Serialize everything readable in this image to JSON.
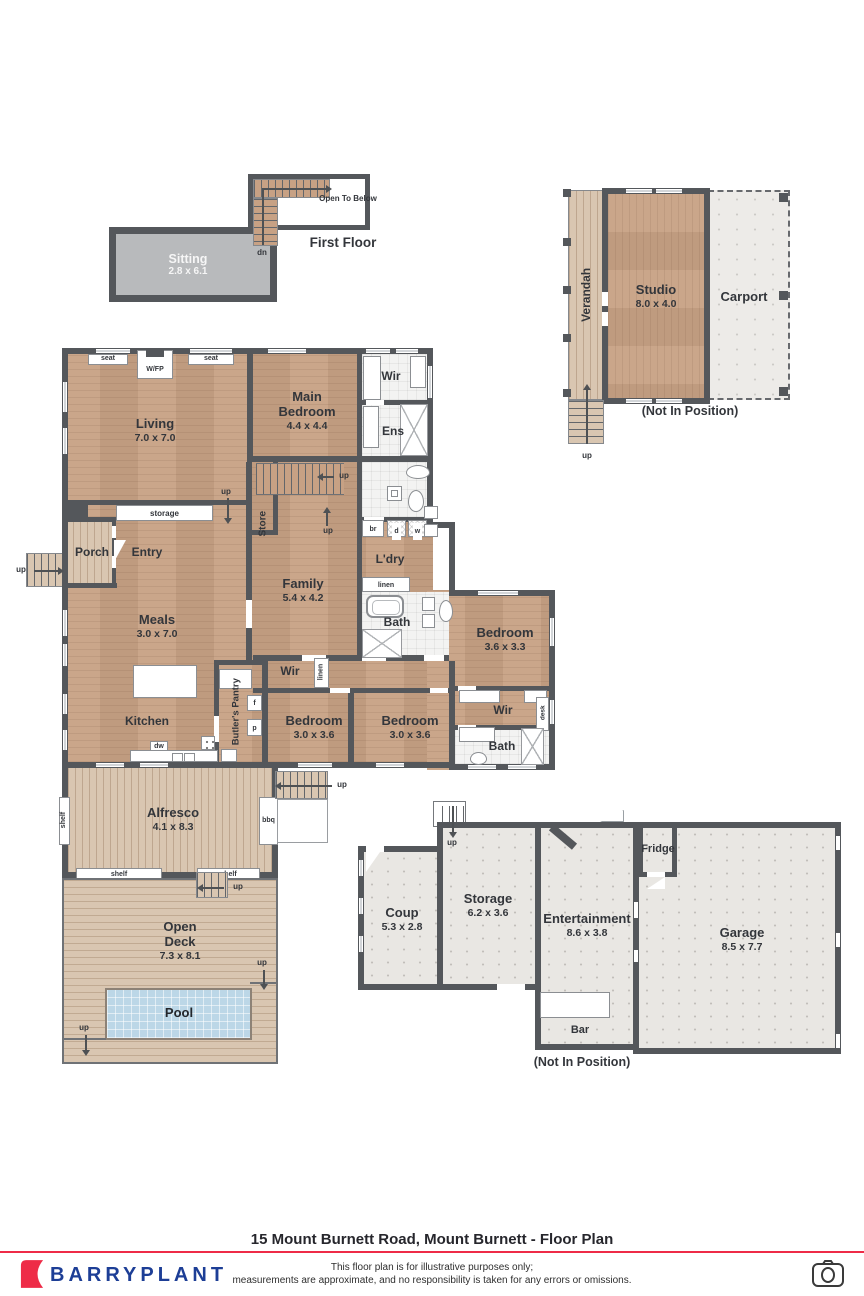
{
  "page_title": "15 Mount Burnett Road, Mount Burnett - Floor Plan",
  "sections": {
    "first_floor": "First Floor",
    "not_in_position": "(Not In Position)"
  },
  "rooms": {
    "sitting": {
      "name": "Sitting",
      "dims": "2.8 x 6.1"
    },
    "studio": {
      "name": "Studio",
      "dims": "8.0 x 4.0"
    },
    "living": {
      "name": "Living",
      "dims": "7.0 x 7.0"
    },
    "main_bedroom": {
      "name": "Main Bedroom",
      "dims": "4.4 x 4.4"
    },
    "family": {
      "name": "Family",
      "dims": "5.4 x 4.2"
    },
    "meals": {
      "name": "Meals",
      "dims": "3.0 x 7.0"
    },
    "bedroom_a": {
      "name": "Bedroom",
      "dims": "3.6 x 3.3"
    },
    "bedroom_b": {
      "name": "Bedroom",
      "dims": "3.0 x 3.6"
    },
    "bedroom_c": {
      "name": "Bedroom",
      "dims": "3.0 x 3.6"
    },
    "alfresco": {
      "name": "Alfresco",
      "dims": "4.1 x 8.3"
    },
    "open_deck": {
      "name": "Open Deck",
      "dims": "7.3 x 8.1"
    },
    "coup": {
      "name": "Coup",
      "dims": "5.3 x 2.8"
    },
    "storage_room": {
      "name": "Storage",
      "dims": "6.2 x 3.6"
    },
    "entertainment": {
      "name": "Entertainment",
      "dims": "8.6 x 3.8"
    },
    "garage": {
      "name": "Garage",
      "dims": "8.5 x 7.7"
    }
  },
  "areas": {
    "verandah": "Verandah",
    "carport": "Carport",
    "porch": "Porch",
    "entry": "Entry",
    "kitchen": "Kitchen",
    "store": "Store",
    "butlers_pantry": "Butler's Pantry",
    "ldry": "L'dry",
    "bath": "Bath",
    "ens": "Ens",
    "wir": "Wir",
    "pool": "Pool",
    "bar": "Bar",
    "fridge": "Fridge"
  },
  "fixtures": {
    "seat": "seat",
    "wfp": "W/FP",
    "storage_cupboard": "storage",
    "linen": "linen",
    "desk": "desk",
    "shelf": "shelf",
    "bbq": "bbq",
    "dw": "dw",
    "br": "br",
    "d": "d",
    "w": "w",
    "f": "f",
    "p": "p",
    "open_to_below": "Open To Below"
  },
  "nav": {
    "up": "up",
    "dn": "dn"
  },
  "footer": {
    "brand": "BARRYPLANT",
    "disclaimer1": "This floor plan is for illustrative purposes only;",
    "disclaimer2": "measurements are approximate, and no responsibility is taken for any errors or omissions."
  },
  "colors": {
    "wall": "#54575b",
    "wood": "#c7a184",
    "deck": "#d9c6b1",
    "carpet": "#b8babc",
    "tile": "#f3f3f2",
    "outbuilding": "#e9e7e3",
    "pool": "#bcd7e7",
    "accent_red": "#ee2b47",
    "brand_blue": "#1d3e96"
  }
}
